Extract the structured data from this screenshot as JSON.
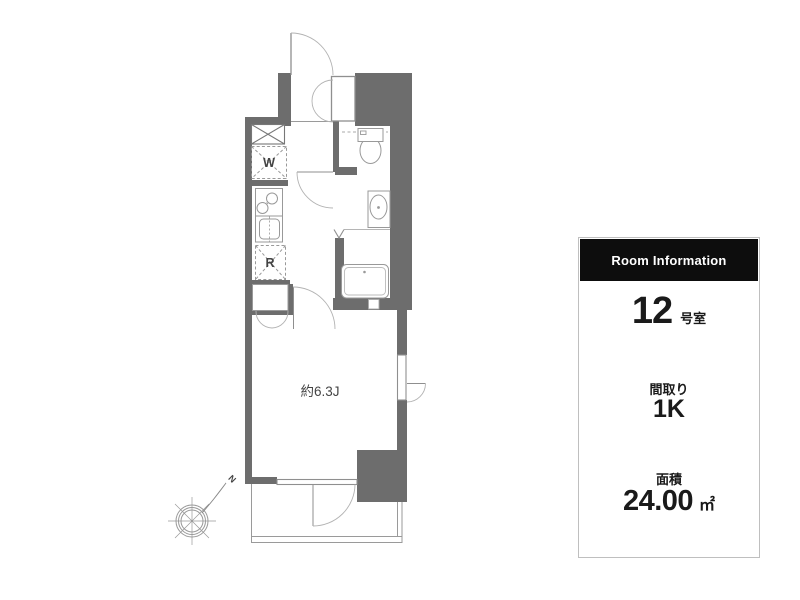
{
  "floor_plan": {
    "room_size_label": "約6.3J",
    "washer_label": "W",
    "fridge_label": "R",
    "north_label": "N"
  },
  "room_info": {
    "header": "Room Information",
    "room_number": "12",
    "room_suffix": "号室",
    "layout_label": "間取り",
    "layout_value": "1K",
    "area_label": "面積",
    "area_value": "24.00",
    "area_unit": "㎡"
  },
  "colors": {
    "wall": "#6d6d6d",
    "thin_line": "#8f8f8f",
    "arc_line": "#b3b3b3",
    "header_bg": "#0d0d0d",
    "header_text": "#ffffff",
    "panel_border": "#bfbfbf",
    "text": "#1a1a1a"
  }
}
